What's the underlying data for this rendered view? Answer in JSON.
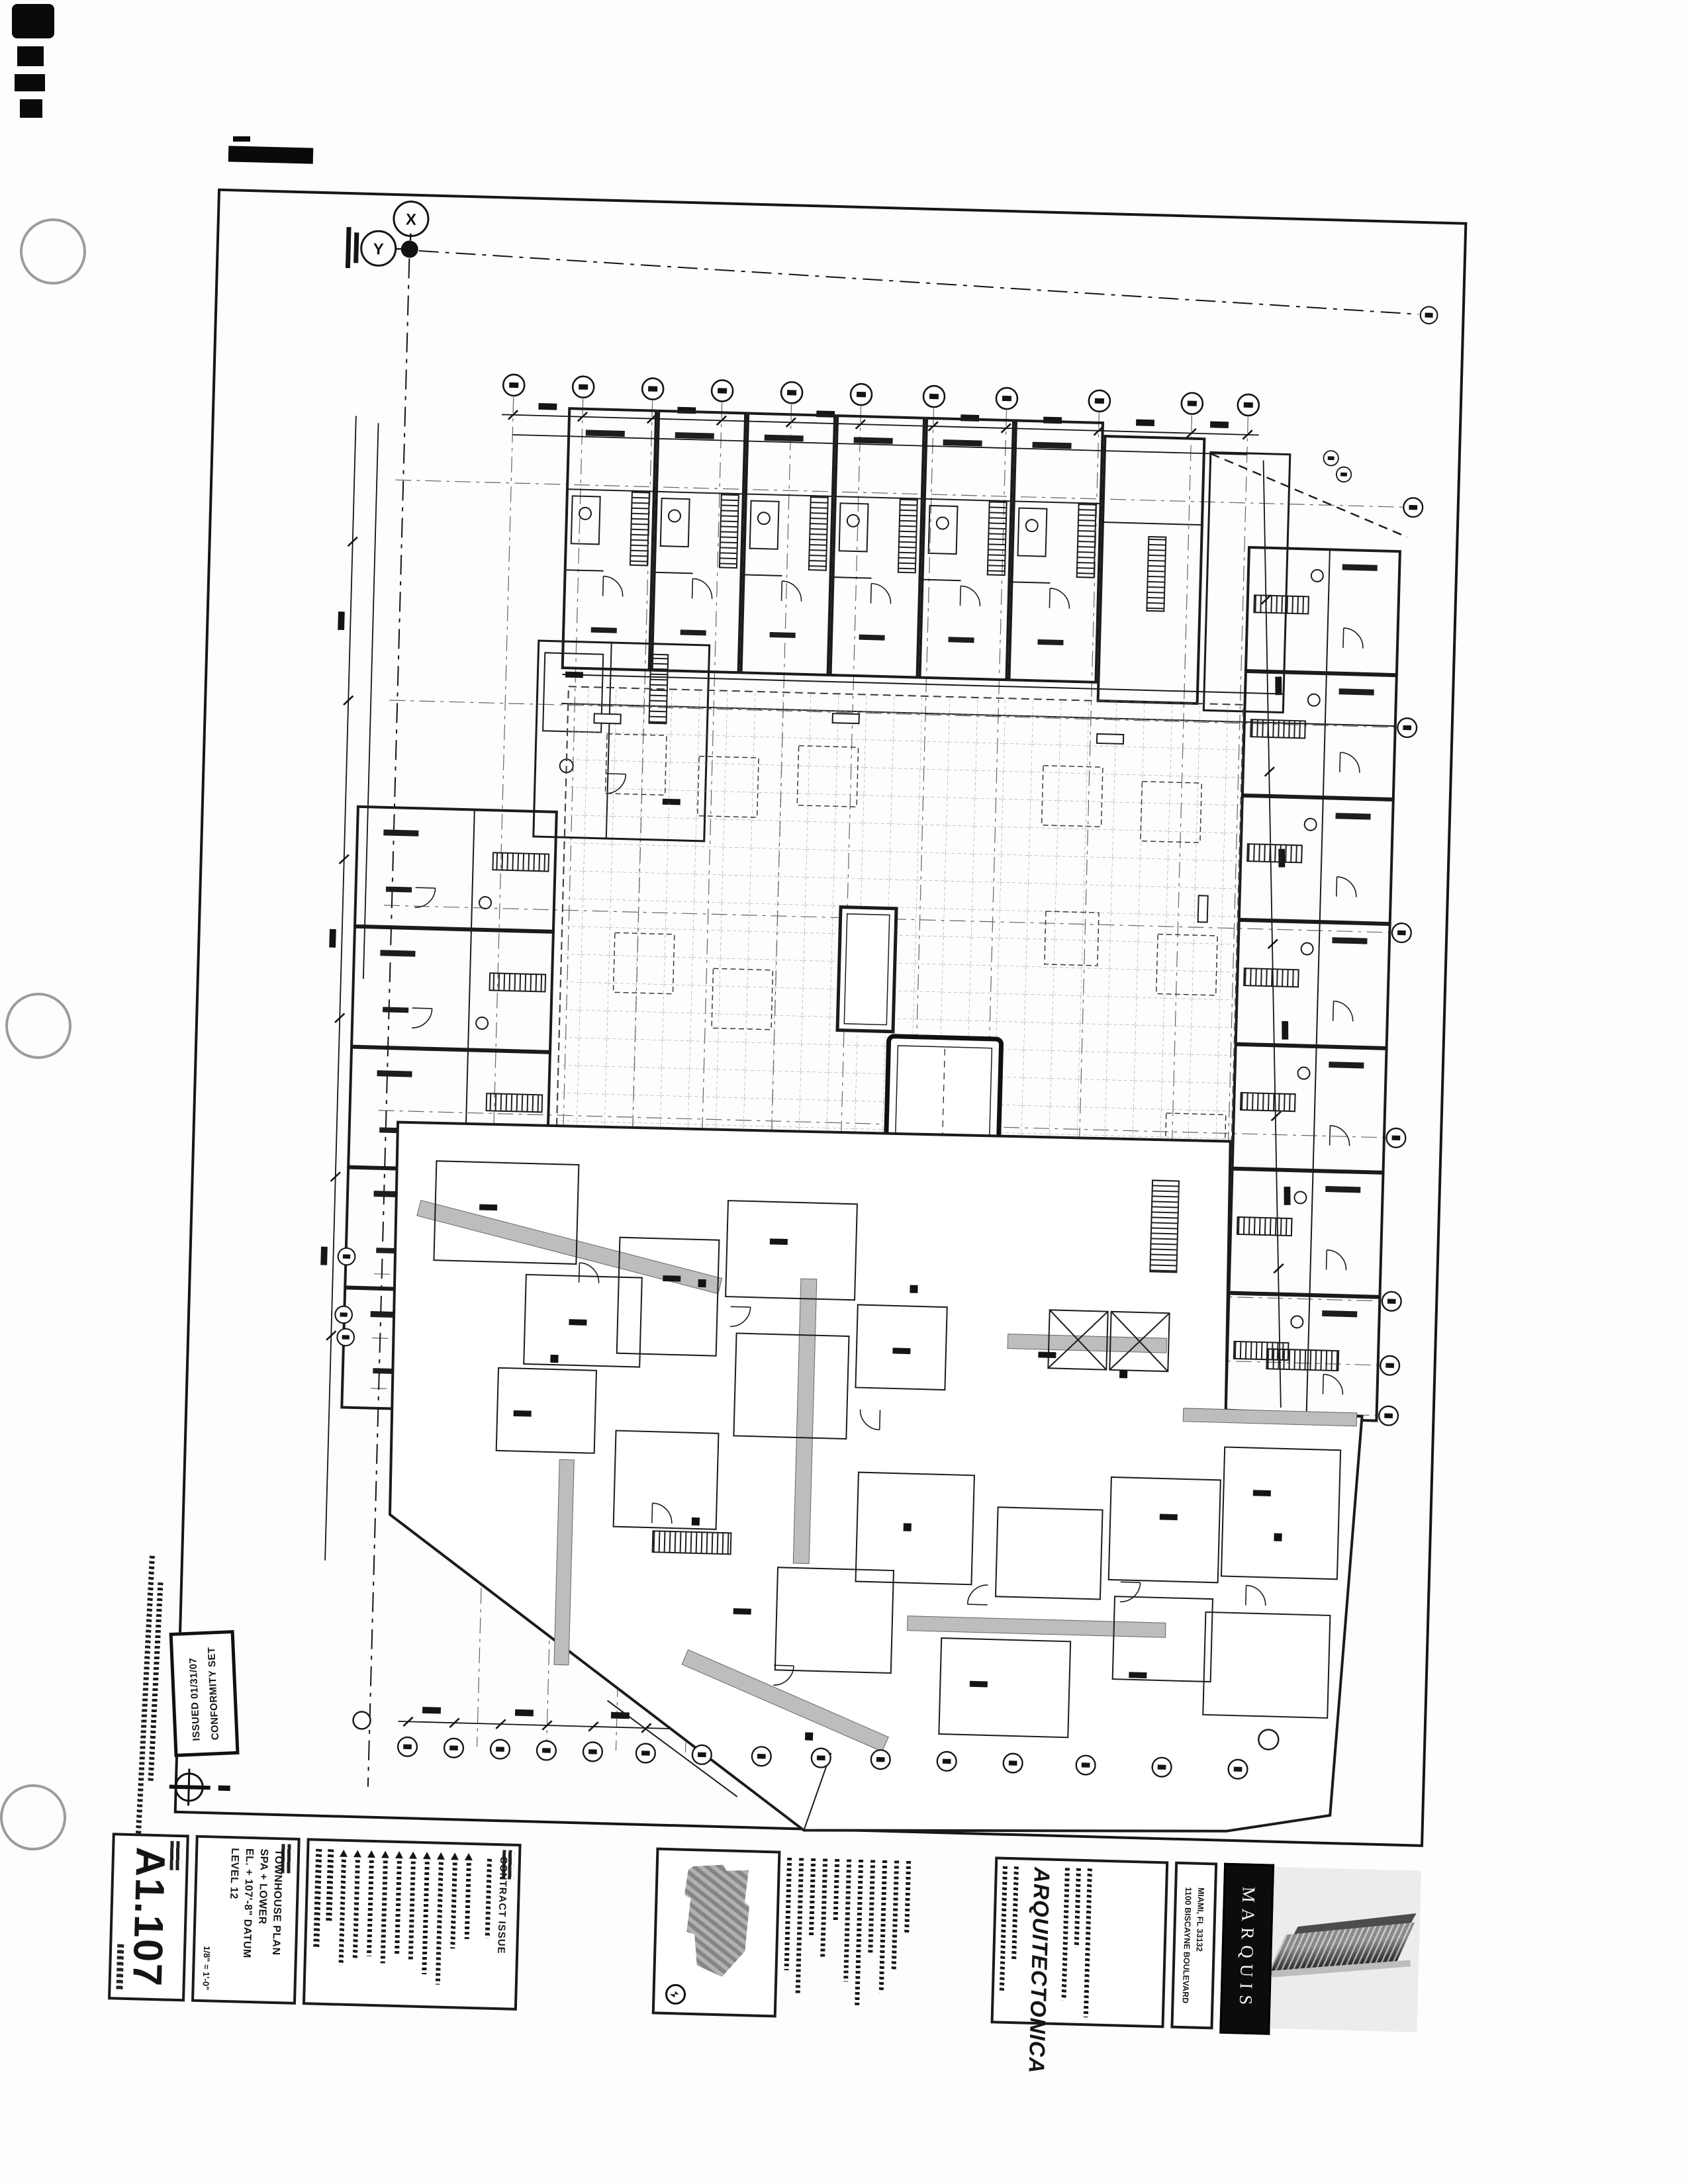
{
  "scan": {
    "stamp": {
      "line1": "CONFORMITY SET",
      "line2": "ISSUED 01/31/07"
    }
  },
  "datum": {
    "x_label": "X",
    "y_label": "Y"
  },
  "title_block": {
    "sheet_number": "A1.107",
    "sheet_title_lines": [
      "LEVEL 12",
      "EL. + 107'-8\" DATUM",
      "SPA + LOWER",
      "TOWNHOUSE PLAN"
    ],
    "scale": "1/8\" = 1'-0\"",
    "issue_label": "CONTRACT ISSUE",
    "firm_name": "ARQUITECTONICA",
    "project_address_line1": "1100 BISCAYNE BOULEVARD",
    "project_address_line2": "MIAMI, FL 33132",
    "logo_text": "MARQUIS"
  }
}
